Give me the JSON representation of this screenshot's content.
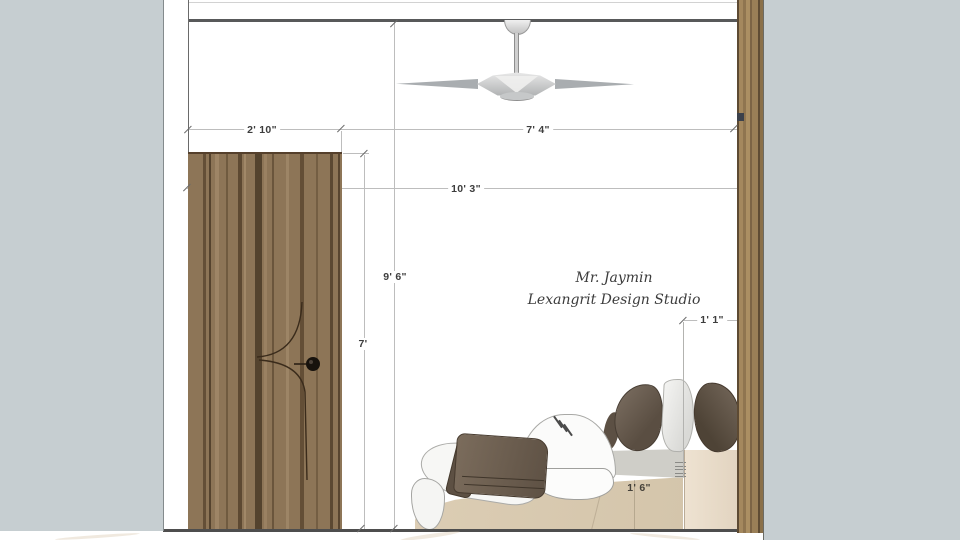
{
  "drawing": {
    "type": "bedroom-interior-elevation",
    "signature": {
      "line1": "Mr. Jaymin",
      "line2": "Lexangrit Design Studio"
    },
    "dimensions": {
      "door_width": "2' 10\"",
      "ceiling_span": "7' 4\"",
      "room_width": "10' 3\"",
      "wall_height": "9' 6\"",
      "door_height": "7'",
      "headboard_depth": "1' 1\"",
      "bed_height": "1' 6\""
    }
  },
  "colors": {
    "bg_gray": "#c6ced1",
    "platform_gray": "#cfcec8",
    "door_wood": "#8d7557",
    "pillar_wood": "#9a7f57",
    "bed_beige": "#d9cab1",
    "side_panel_beige": "#e8dcca",
    "pillow_dark": "#675b4f",
    "blanket_brown": "#6e6051",
    "line_dark": "#58595a",
    "dim_text": "#3d3d3d"
  }
}
